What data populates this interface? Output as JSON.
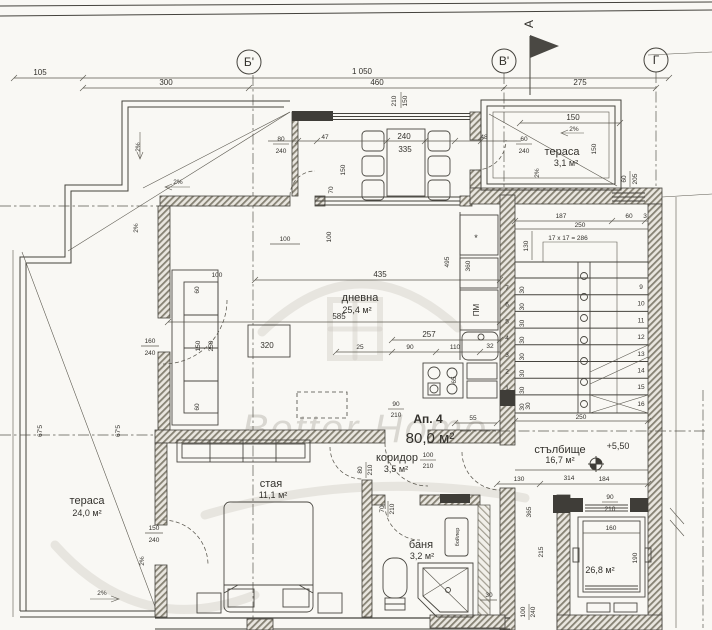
{
  "watermark": {
    "brand": "Better Home"
  },
  "axes": {
    "b_prime": "Б'",
    "v_prime": "В'",
    "g": "Г",
    "north": "А"
  },
  "apartment": {
    "name": "Ап. 4",
    "area": "80,0 м²"
  },
  "rooms": {
    "living": {
      "name": "дневна",
      "area": "25,4 м²"
    },
    "terrace_small": {
      "name": "тераса",
      "area": "3,1 м²"
    },
    "terrace_large": {
      "name": "тераса",
      "area": "24,0 м²"
    },
    "bedroom": {
      "name": "стая",
      "area": "11,1 м²"
    },
    "bathroom": {
      "name": "баня",
      "area": "3,2 м²"
    },
    "corridor": {
      "name": "коридор",
      "area": "3,5 м²"
    },
    "stairwell": {
      "name": "стълбище",
      "area": "16,7 м²"
    },
    "shaft": {
      "area": "26,8 м²"
    }
  },
  "stairs": {
    "formula": "17 x 17 = 286",
    "left_numbers": [
      "7",
      "6",
      "5",
      "4",
      "3",
      "2",
      "1"
    ],
    "right_numbers": [
      "9",
      "10",
      "11",
      "12",
      "13",
      "14",
      "15",
      "16"
    ],
    "riser": "30",
    "level": "+5,50"
  },
  "labels": {
    "slope": "2%",
    "dishwasher": "ПМ",
    "boiler": "бойлер",
    "star": "*",
    "l675": "67'5"
  },
  "dims": {
    "top": [
      "105",
      "1 050",
      "300",
      "460",
      "275",
      "210",
      "150"
    ],
    "balcony": [
      "80",
      "240",
      "47",
      "240",
      "335",
      "48",
      "60",
      "240",
      "150",
      "70",
      "100",
      "100"
    ],
    "terr31": [
      "150",
      "150",
      "60",
      "205"
    ],
    "left": [
      "160",
      "240",
      "150",
      "240"
    ],
    "living": [
      "435",
      "585",
      "257",
      "25",
      "90",
      "110",
      "32",
      "100",
      "60",
      "150",
      "250",
      "60",
      "320",
      "495",
      "360",
      "65"
    ],
    "corridor": [
      "90",
      "210",
      "80",
      "210",
      "70",
      "210",
      "100",
      "210",
      "55",
      "30"
    ],
    "bath": [
      "30",
      "100",
      "240"
    ],
    "stairs": [
      "187",
      "60",
      "3",
      "250",
      "130",
      "250"
    ],
    "landing": [
      "314",
      "130",
      "184",
      "90",
      "210",
      "365",
      "215"
    ],
    "elevator": [
      "160",
      "190"
    ]
  }
}
